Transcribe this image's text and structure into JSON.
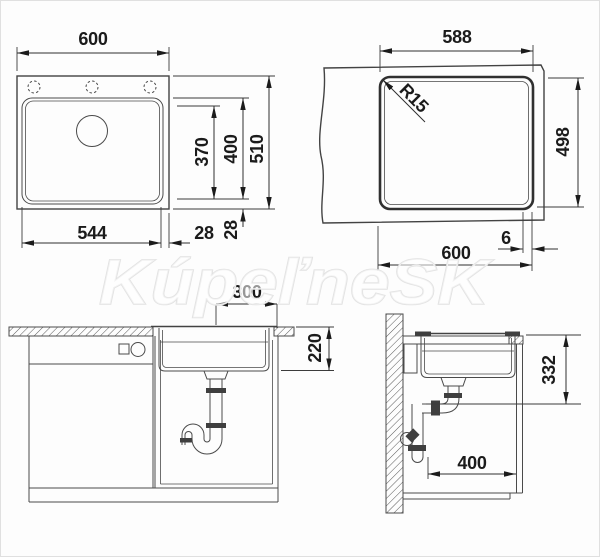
{
  "watermark": {
    "text": "KúpeľneSK"
  },
  "top_view": {
    "width": "600",
    "inner_depth": "370",
    "bowl_depth": "400",
    "depth": "510",
    "bowl_width": "544",
    "rim_right": "28",
    "rim_bottom": "28"
  },
  "cutout_view": {
    "width": "588",
    "corner_radius": "R15",
    "height": "498",
    "outer_width": "600",
    "edge_gap": "6"
  },
  "front_view": {
    "drain_offset": "300",
    "bowl_height": "220"
  },
  "side_view": {
    "drain_height": "332",
    "min_depth": "400"
  }
}
